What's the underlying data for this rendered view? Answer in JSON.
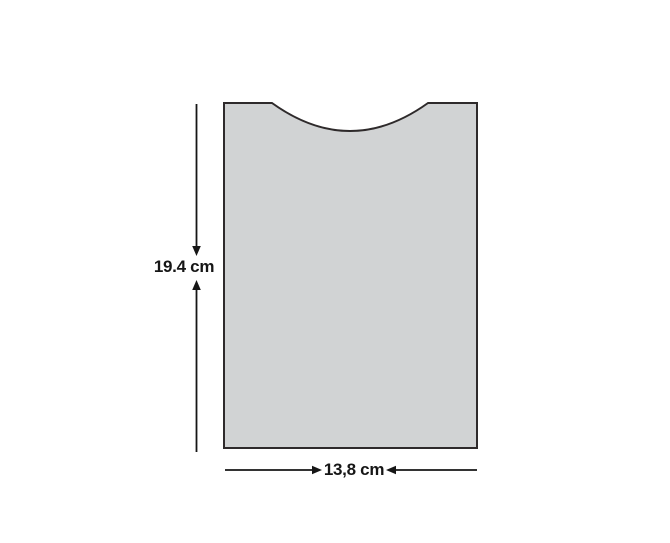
{
  "diagram": {
    "height_dimension": {
      "label": "19.4 cm"
    },
    "width_dimension": {
      "label": "13,8 cm"
    }
  },
  "colors": {
    "background": "#ffffff",
    "shape_fill": "#d1d3d4",
    "shape_stroke": "#2e2a2b",
    "dimension_color": "#161616"
  }
}
